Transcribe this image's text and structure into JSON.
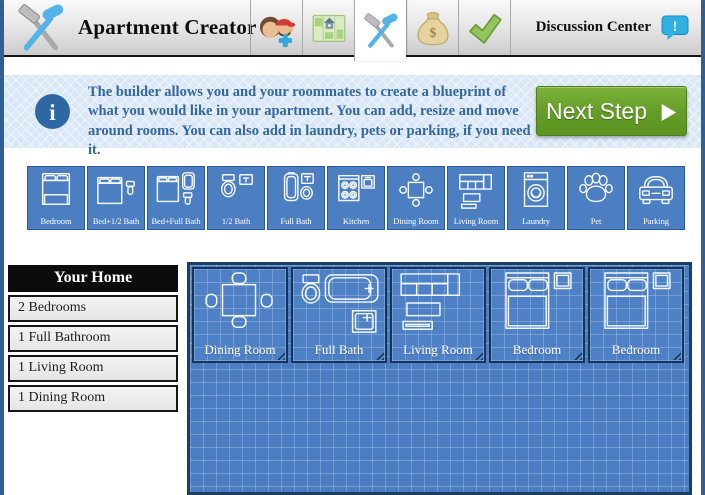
{
  "colors": {
    "frame_blue": "#315F93",
    "tile_blue": "#4C7EC2",
    "blueprint_blue": "#4B7DC2",
    "banner_blue": "#D9E7F6",
    "text_blue": "#33679E",
    "button_green": "#69A22B",
    "discussion_cyan": "#2FB0E3"
  },
  "header": {
    "title": "Apartment Creator",
    "logo_icon": "crossed-hammers-icon",
    "tabs": [
      {
        "icon": "roommates-icon",
        "active": false
      },
      {
        "icon": "map-icon",
        "active": false
      },
      {
        "icon": "hammer-tools-icon",
        "active": true
      },
      {
        "icon": "money-bag-icon",
        "active": false
      },
      {
        "icon": "checkmark-icon",
        "active": false
      }
    ],
    "discussion_label": "Discussion Center",
    "discussion_icon": "alert-bubble-icon"
  },
  "banner": {
    "info_icon": "info-icon",
    "text": "The builder allows you and your roommates to create a blueprint of what you would like in your apartment. You can add, resize and move around rooms. You can also add in laundry, pets or parking, if you need it.",
    "next_button_label": "Next Step",
    "next_button_icon": "play-arrow-icon"
  },
  "toolbar": {
    "items": [
      {
        "label": "Bedroom",
        "icon": "bed-icon"
      },
      {
        "label": "Bed+1/2 Bath",
        "icon": "bed-half-bath-icon"
      },
      {
        "label": "Bed+Full Bath",
        "icon": "bed-full-bath-icon"
      },
      {
        "label": "1/2 Bath",
        "icon": "half-bath-icon"
      },
      {
        "label": "Full Bath",
        "icon": "full-bath-icon"
      },
      {
        "label": "Kitchen",
        "icon": "kitchen-icon"
      },
      {
        "label": "Dining Room",
        "icon": "dining-room-icon"
      },
      {
        "label": "Living Room",
        "icon": "living-room-icon"
      },
      {
        "label": "Laundry",
        "icon": "laundry-icon"
      },
      {
        "label": "Pet",
        "icon": "paw-icon"
      },
      {
        "label": "Parking",
        "icon": "car-icon"
      }
    ]
  },
  "summary": {
    "title": "Your Home",
    "items": [
      "2 Bedrooms",
      "1 Full Bathroom",
      "1 Living Room",
      "1 Dining Room"
    ]
  },
  "blueprint": {
    "rooms": [
      {
        "label": "Dining Room",
        "icon": "room-dining-icon"
      },
      {
        "label": "Full Bath",
        "icon": "room-fullbath-icon"
      },
      {
        "label": "Living Room",
        "icon": "room-living-icon"
      },
      {
        "label": "Bedroom",
        "icon": "room-bedroom-icon"
      },
      {
        "label": "Bedroom",
        "icon": "room-bedroom-icon"
      }
    ]
  }
}
